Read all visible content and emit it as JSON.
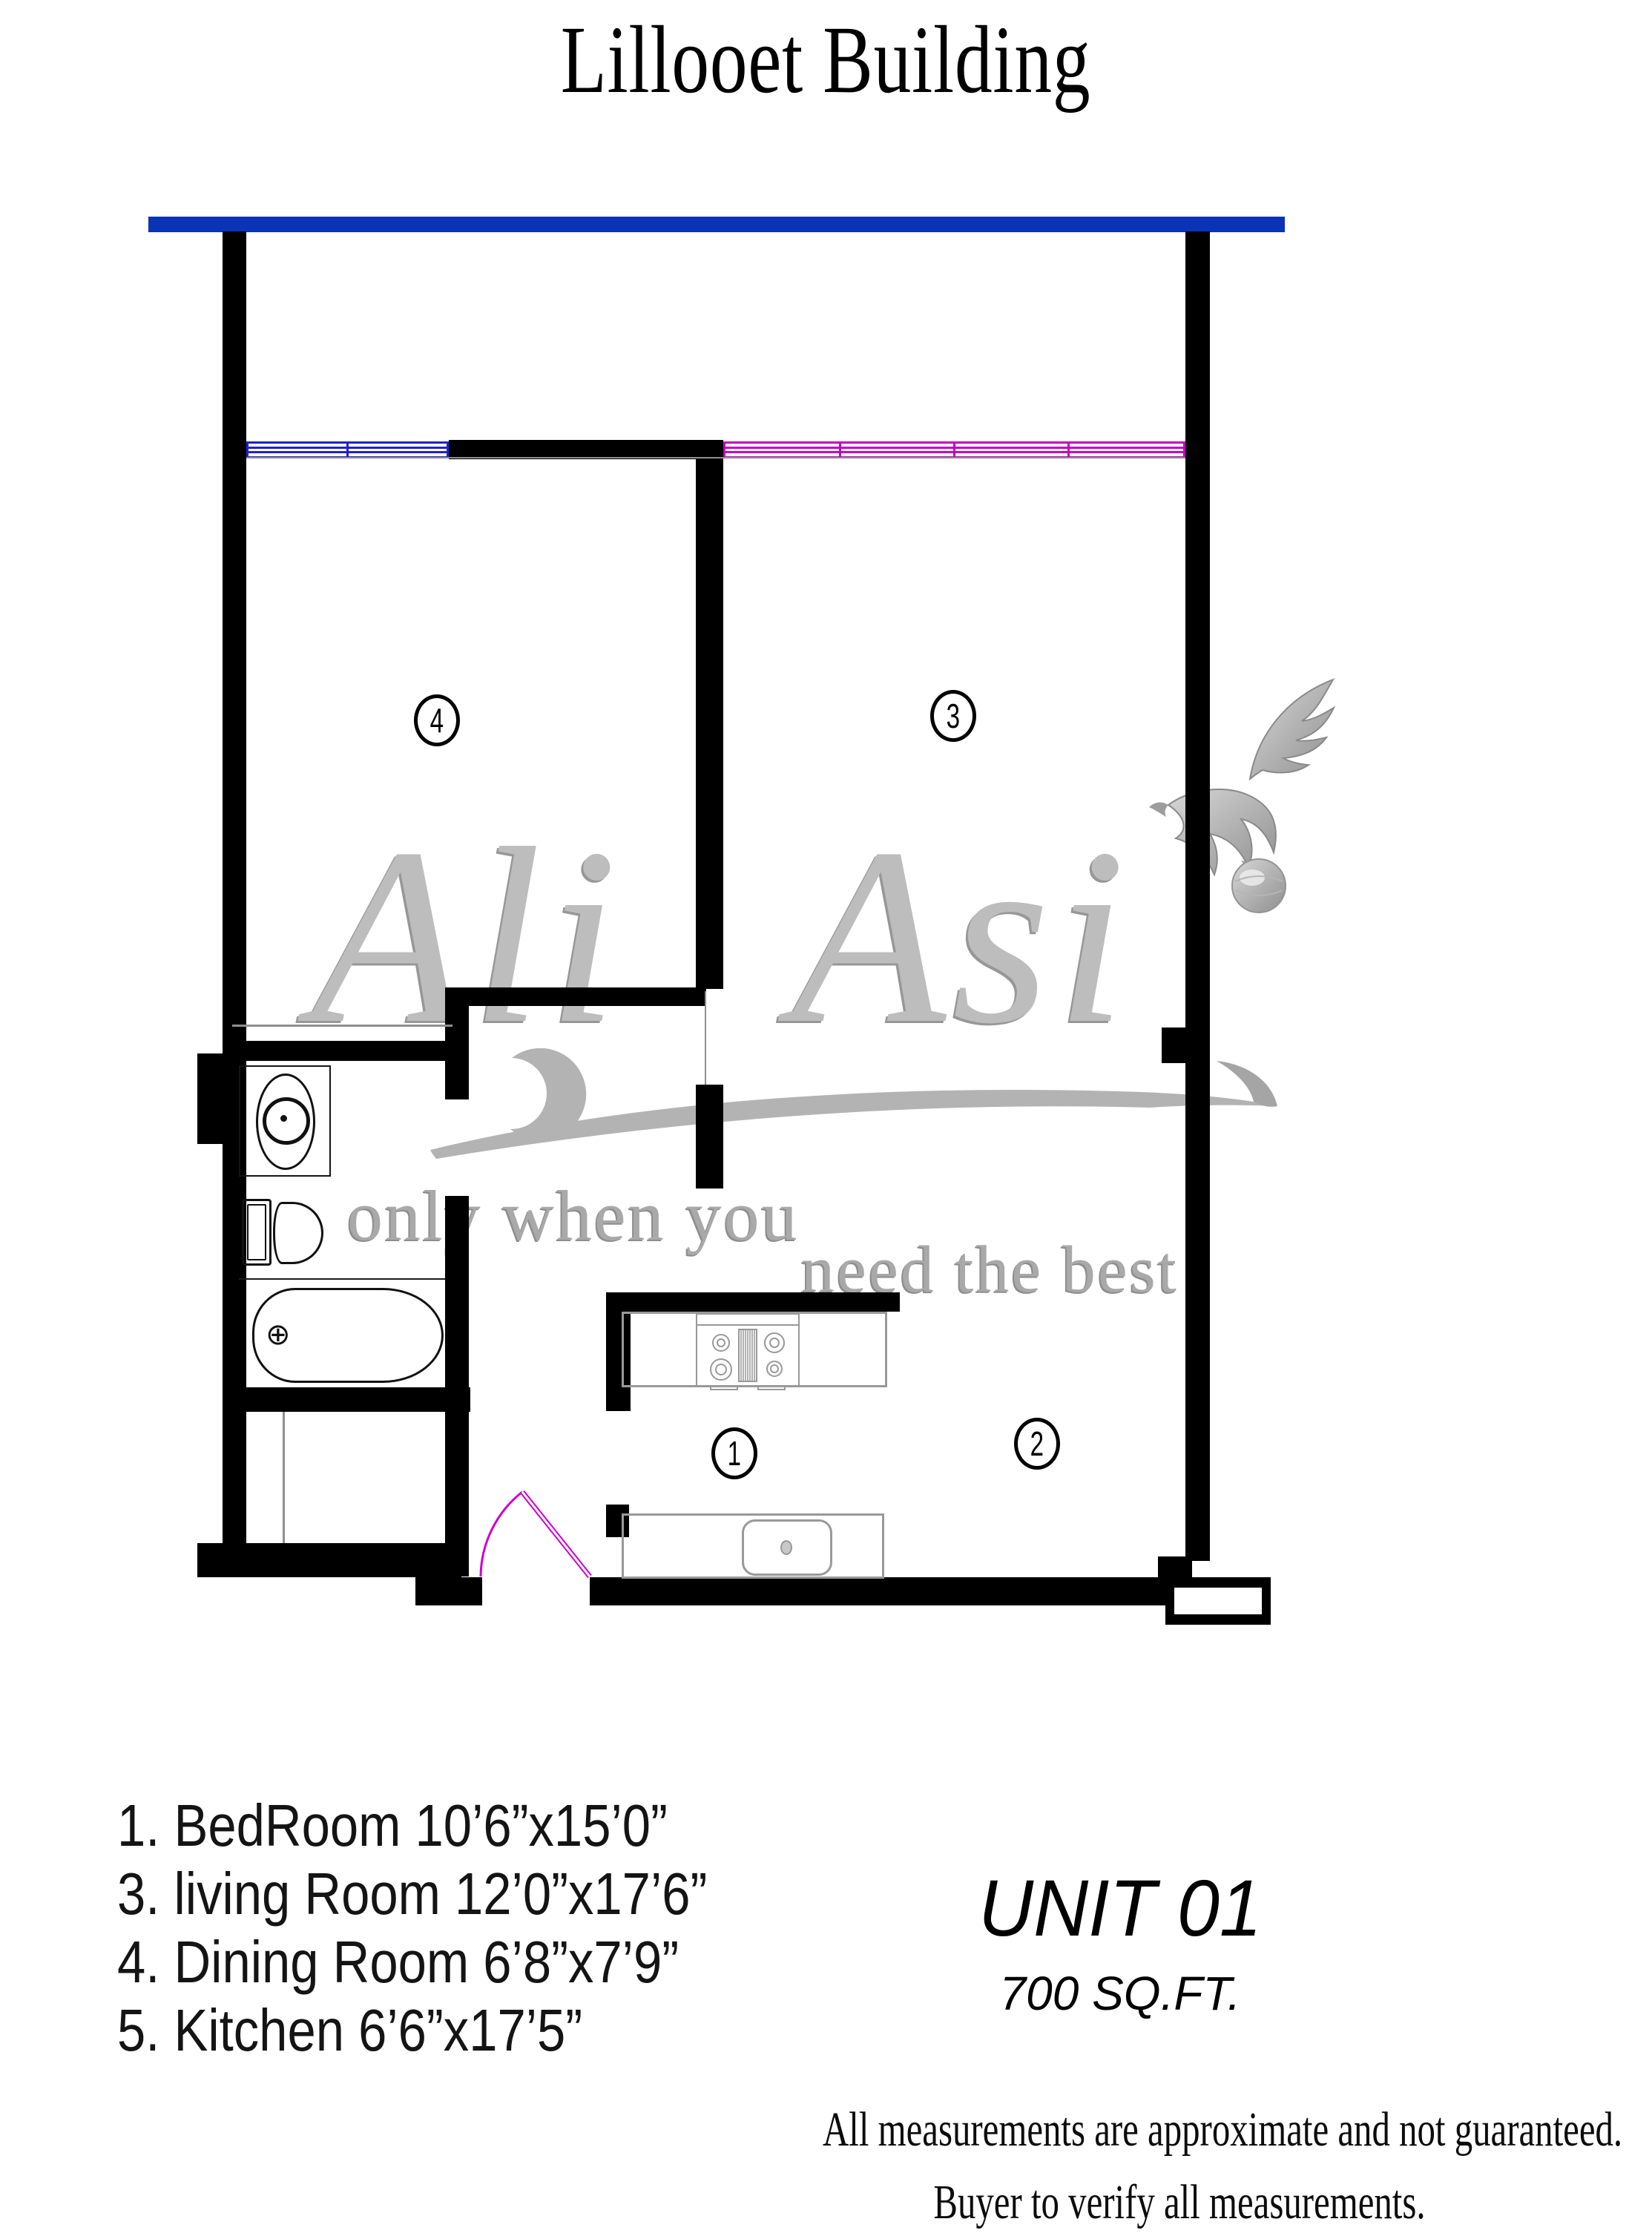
{
  "title": "Lillooet Building",
  "floor_plan": {
    "room_markers": [
      {
        "number": "1"
      },
      {
        "number": "2"
      },
      {
        "number": "3"
      },
      {
        "number": "4"
      }
    ]
  },
  "watermark": {
    "brand": "Ali Asi",
    "tagline_line1": "only when you",
    "tagline_line2": "need the best"
  },
  "legend": {
    "items": [
      "1. BedRoom 10’6”x15’0”",
      "3. living Room 12’0”x17’6”",
      "4. Dining Room 6’8”x7’9”",
      "5. Kitchen 6’6”x17’5”"
    ]
  },
  "unit": {
    "name": "UNIT 01",
    "area": "700 SQ.FT."
  },
  "disclaimer": {
    "line1": "All measurements are approximate and not guaranteed.",
    "line2": "Buyer to verify all measurements."
  },
  "colors": {
    "balcony": "#0a33b5",
    "window_blue": "#2121cc",
    "window_magenta": "#c400c4",
    "door_magenta": "#cc00cc",
    "wall": "#000000",
    "fixture": "#999999",
    "watermark": "#bdbdbd"
  }
}
